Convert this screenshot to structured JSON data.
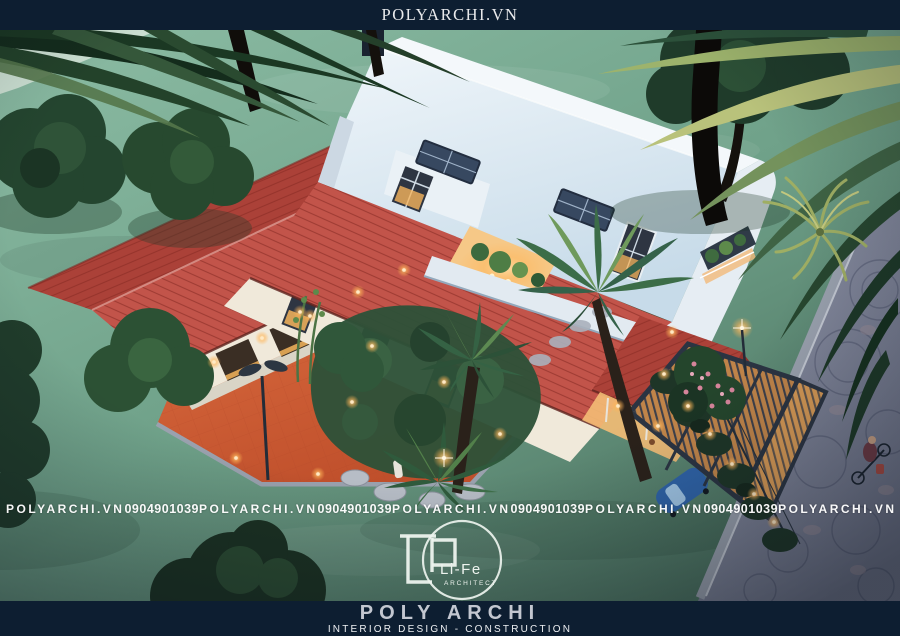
{
  "header": {
    "title": "POLYARCHI.VN"
  },
  "watermark": {
    "brand": "POLYARCHI.VN",
    "phone": "0904901039"
  },
  "logo": {
    "monogram": "LP",
    "name": "Li-Fe",
    "subtitle": "ARCHITECT"
  },
  "footer": {
    "brand": "POLY ARCHI",
    "tagline": "INTERIOR DESIGN - CONSTRUCTION"
  },
  "scene": {
    "alt": "Aerial dusk 3D render of a modern villa: white gambrel roof with skylights and planted atrium, red tiled wings, warm-lit white walls, orange paved courtyard with lamp post, tropical garden with palms, timber pergola carport with blue car, hedge with bollard lights, fan-patterned cobblestone street with a cyclist, teal lawn with trees and palm fronds"
  },
  "palette": {
    "navy": "#0d1e31",
    "header_text": "#e9eaec",
    "grass_light": "#8cbca4",
    "grass_mid": "#6fa189",
    "grass_dark": "#46695a",
    "pale_lawn": "#d9e8dc",
    "roof_red_light": "#c2544a",
    "roof_red_mid": "#ab4138",
    "roof_red_dark": "#8c322c",
    "roof_white": "#edf4f9",
    "roof_white_shade": "#c7dbe9",
    "wall_warm": "#f0e9da",
    "window_dark": "#2e3542",
    "glass_warm": "#f5b45c",
    "orange_tile": "#d2613a",
    "orange_tile_dark": "#b84c28",
    "stone": "#9aa1ae",
    "cobble": "#878ca0",
    "pergola_wood": "#c08449",
    "pergola_wood_lit": "#d89a55",
    "pergola_frame": "#2b3442",
    "foliage_dark": "#1c3526",
    "foliage_mid": "#2f5038",
    "palm_lit": "#a8bb74",
    "warm_light": "#ffd9a0",
    "car_blue": "#2f63a7",
    "flower_pink": "#d6849b",
    "wm_white": "#ffffff",
    "footer_silver": "#c3c7d0",
    "footer_white": "#eef0f3"
  }
}
